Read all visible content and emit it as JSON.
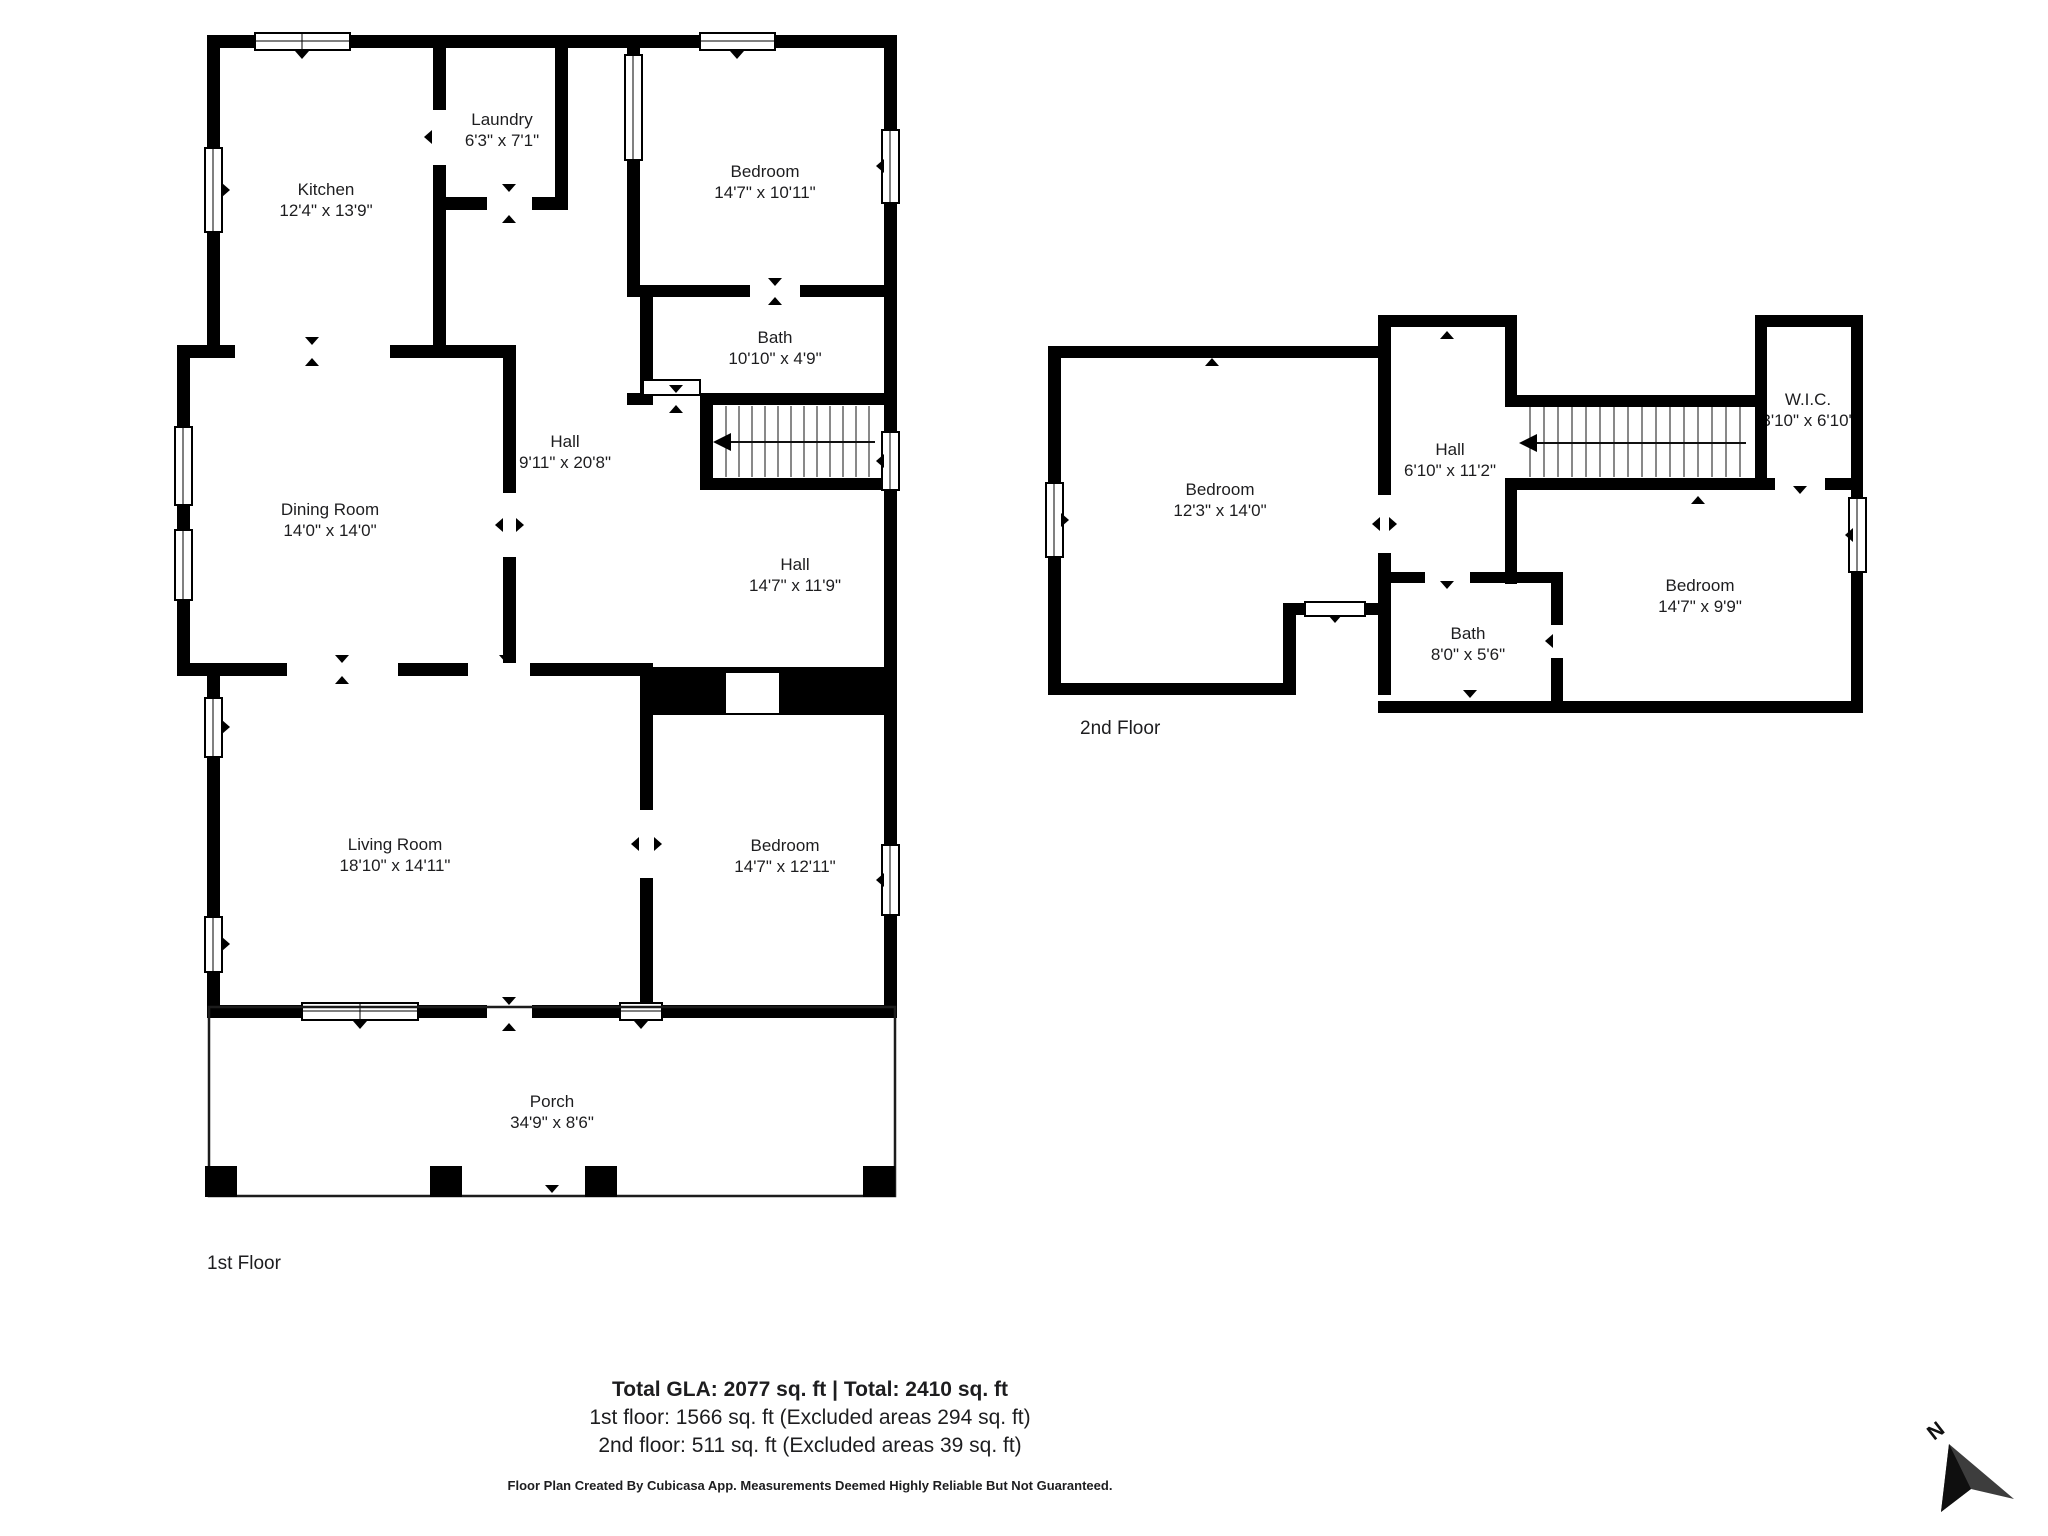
{
  "floors": [
    {
      "label": "1st Floor",
      "rooms": [
        {
          "name": "Kitchen",
          "dims": "12'4\" x 13'9\""
        },
        {
          "name": "Laundry",
          "dims": "6'3\" x 7'1\""
        },
        {
          "name": "Bedroom",
          "dims": "14'7\" x 10'11\""
        },
        {
          "name": "Bath",
          "dims": "10'10\" x 4'9\""
        },
        {
          "name": "Hall",
          "dims": "9'11\" x 20'8\""
        },
        {
          "name": "Hall",
          "dims": "14'7\" x 11'9\""
        },
        {
          "name": "Dining Room",
          "dims": "14'0\" x 14'0\""
        },
        {
          "name": "Living Room",
          "dims": "18'10\" x 14'11\""
        },
        {
          "name": "Bedroom",
          "dims": "14'7\" x 12'11\""
        },
        {
          "name": "Porch",
          "dims": "34'9\" x 8'6\""
        }
      ]
    },
    {
      "label": "2nd Floor",
      "rooms": [
        {
          "name": "Bedroom",
          "dims": "12'3\" x 14'0\""
        },
        {
          "name": "Hall",
          "dims": "6'10\" x 11'2\""
        },
        {
          "name": "W.I.C.",
          "dims": "3'10\" x 6'10\""
        },
        {
          "name": "Bedroom",
          "dims": "14'7\" x 9'9\""
        },
        {
          "name": "Bath",
          "dims": "8'0\" x 5'6\""
        }
      ]
    }
  ],
  "footer": {
    "total_line": "Total GLA: 2077 sq. ft | Total: 2410 sq. ft",
    "floor1_line": "1st floor: 1566 sq. ft (Excluded areas 294 sq. ft)",
    "floor2_line": "2nd floor: 511 sq. ft (Excluded areas 39 sq. ft)",
    "disclaimer": "Floor Plan Created By Cubicasa App. Measurements Deemed Highly Reliable But Not Guaranteed."
  },
  "compass": {
    "north_label": "N"
  }
}
